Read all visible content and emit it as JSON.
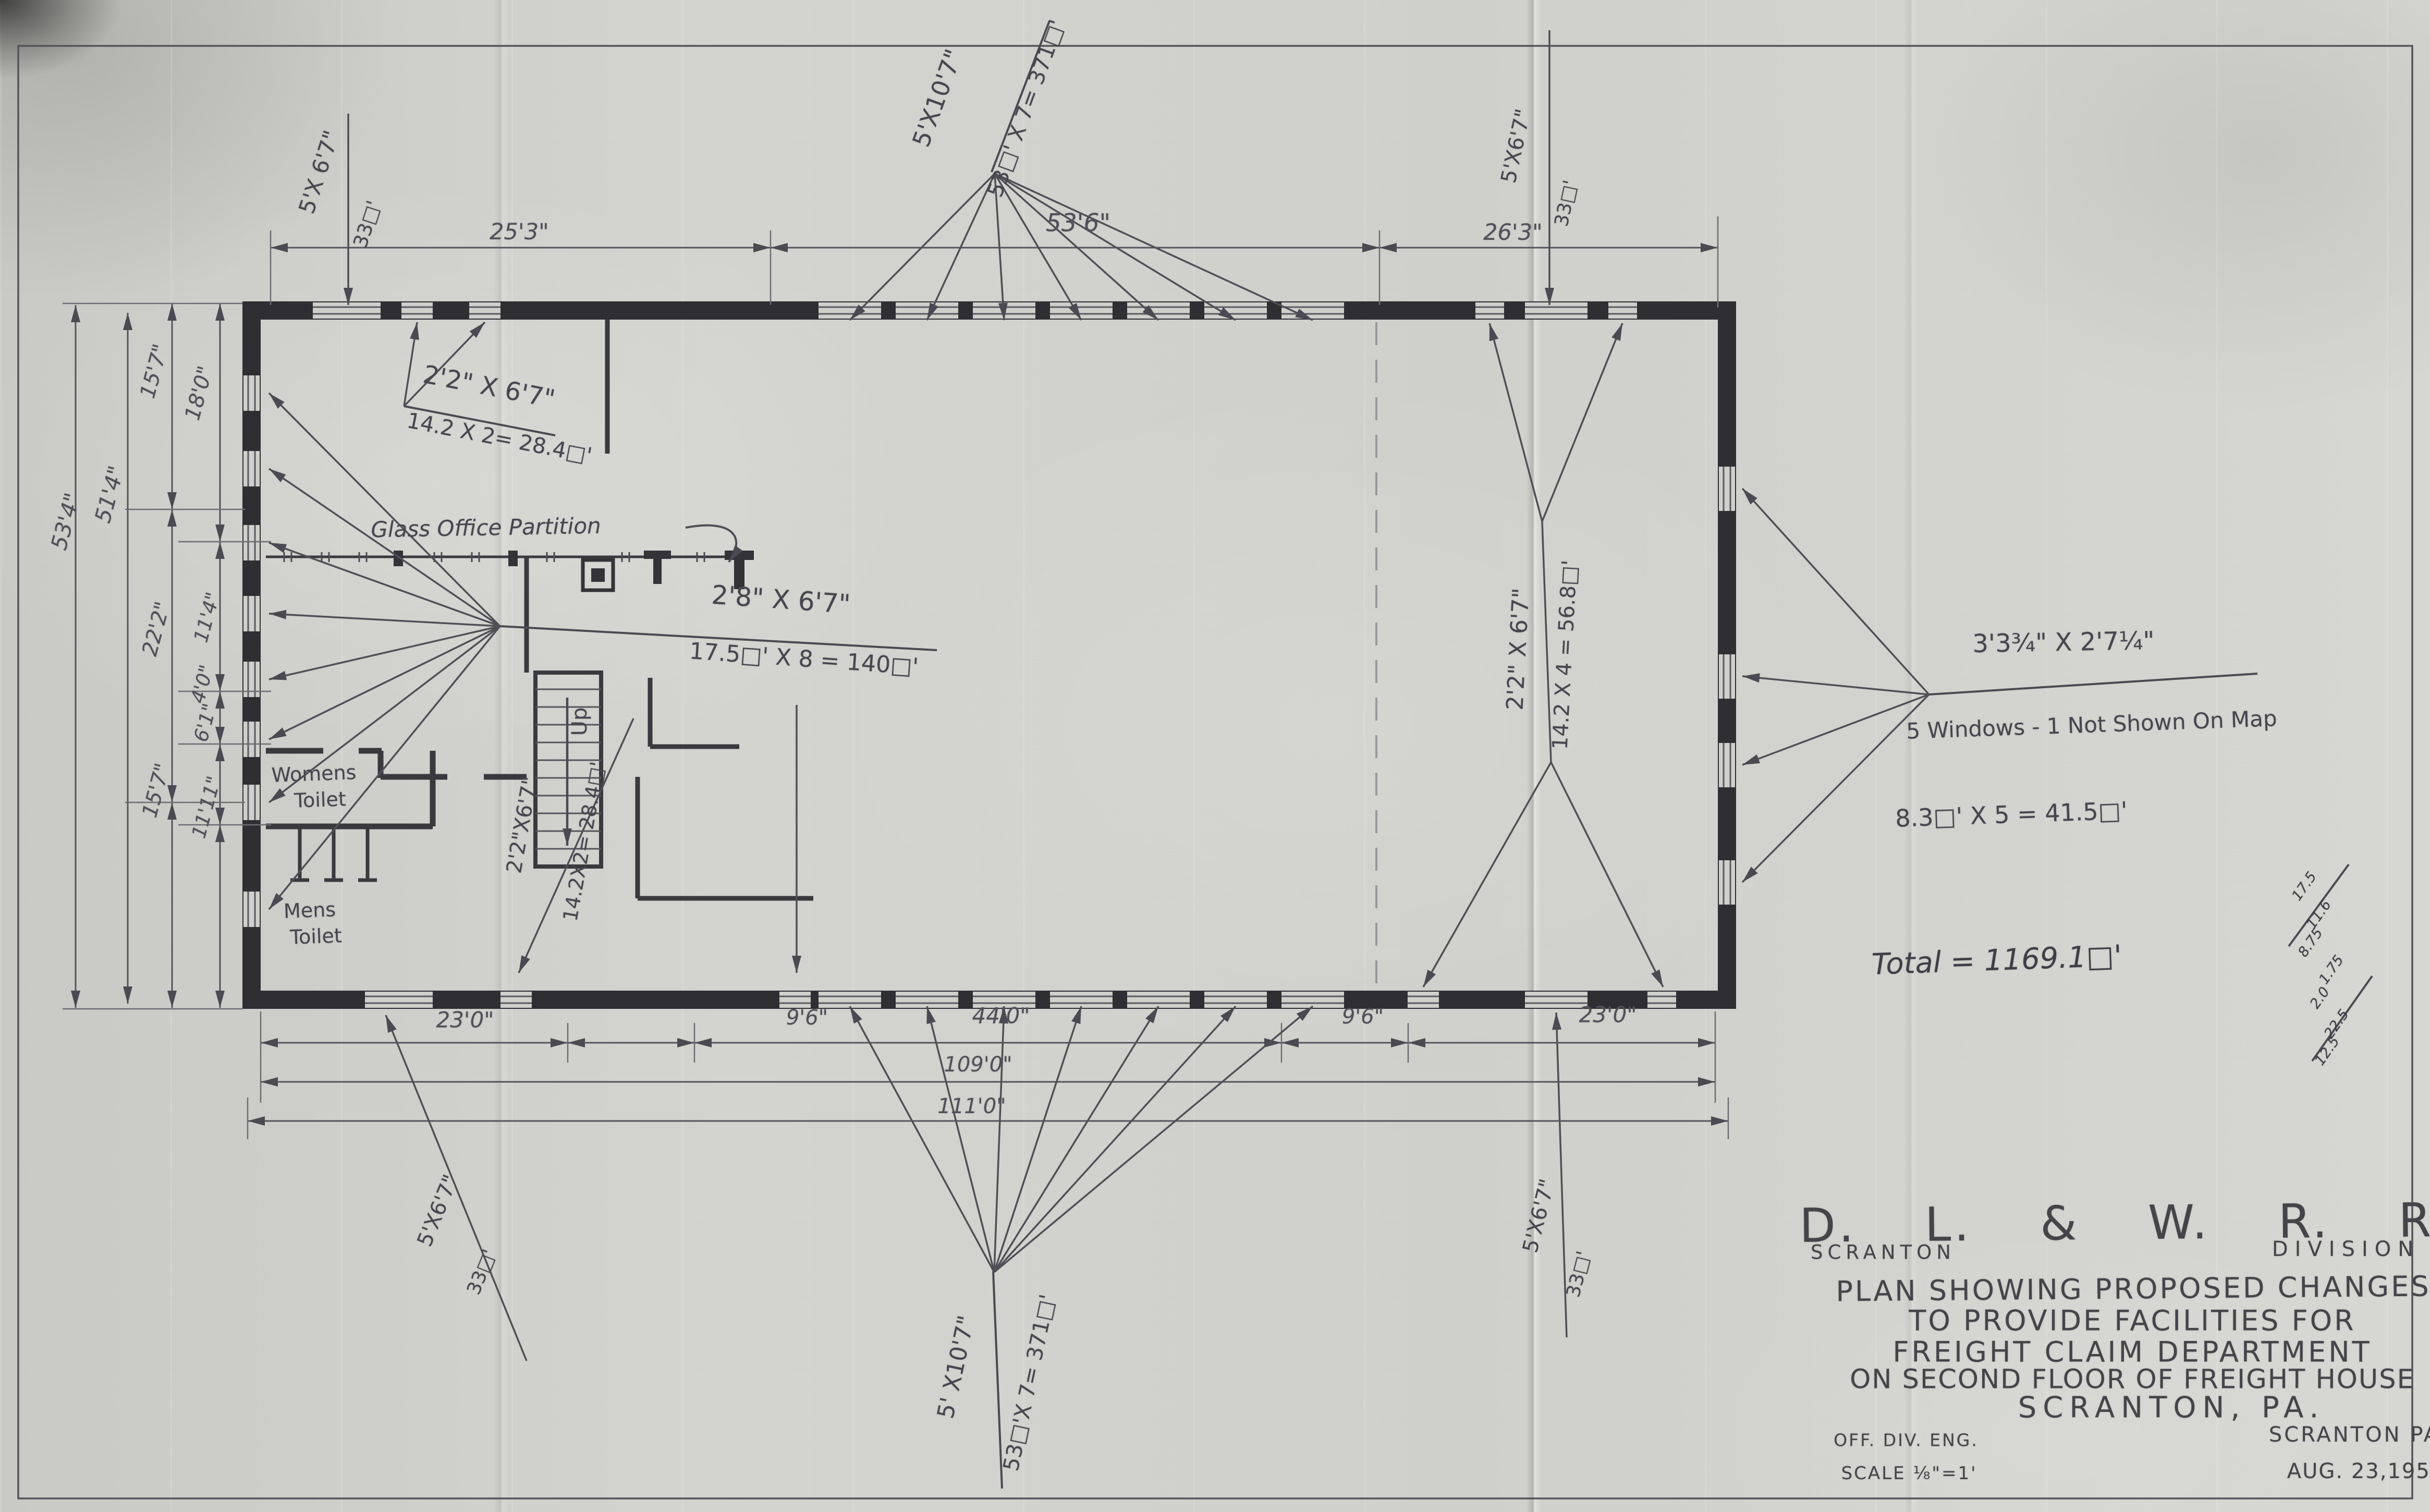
{
  "colors": {
    "paper": "#cfcfcb",
    "pencil": "#4b4a52",
    "wall": "#2f2e33"
  },
  "title_block": {
    "railroad": "D. L. & W. R. R.",
    "division_left": "SCRANTON",
    "division_right": "DIVISION",
    "lines": [
      "PLAN SHOWING PROPOSED CHANGES",
      "TO PROVIDE FACILITIES FOR",
      "FREIGHT CLAIM DEPARTMENT",
      "ON SECOND FLOOR OF FREIGHT HOUSE",
      "SCRANTON, PA."
    ],
    "office": "OFF. DIV. ENG.",
    "location": "SCRANTON PA",
    "scale": "SCALE ⅛\"=1'",
    "date": "AUG. 23,1957"
  },
  "dimensions": {
    "top": [
      "25'3\"",
      "53'6\"",
      "26'3\""
    ],
    "left": {
      "overall": "53'4\"",
      "inner": "51'4\"",
      "chain_a": [
        "15'7\"",
        "22'2\"",
        "15'7\""
      ],
      "chain_b": [
        "18'0\"",
        "11'4\"",
        "4'0\"",
        "6'1\"",
        "11'11\""
      ]
    },
    "bottom": {
      "segments": [
        "23'0\"",
        "9'6\"",
        "44'0\"",
        "9'6\"",
        "23'0\""
      ],
      "subtotal": "109'0\"",
      "total": "111'0\""
    }
  },
  "windows": {
    "top_left_single": {
      "size": "5'X 6'7\"",
      "area": "33□'"
    },
    "top_center": {
      "size": "5'X10'7\"",
      "calc": "53□' X 7= 371□'"
    },
    "top_right_single": {
      "size": "5'X6'7\"",
      "area": "33□'"
    },
    "upper_left_pair": {
      "size": "2'2\" X 6'7\"",
      "calc": "14.2 X 2= 28.4□'"
    },
    "left_wall": {
      "size": "2'8\" X 6'7\"",
      "calc": "17.5□' X 8 = 140□'"
    },
    "lower_left_pair": {
      "size": "2'2\"X6'7\"",
      "calc": "14.2X2= 28.4□'"
    },
    "bottom_left_single": {
      "size": "5'X6'7\"",
      "area": "33□'"
    },
    "bottom_center": {
      "size": "5' X10'7\"",
      "calc": "53□'X 7= 371□'"
    },
    "bottom_right_single": {
      "size": "5'X6'7\"",
      "area": "33□'"
    },
    "right_group": {
      "size": "2'2\" X 6'7\"",
      "calc": "14.2 X 4 = 56.8□'"
    },
    "right_wall": {
      "size": "3'3¾\" X 2'7¼\"",
      "note": "5 Windows - 1 Not Shown On Map",
      "calc": "8.3□' X 5 = 41.5□'"
    }
  },
  "rooms": {
    "glass_partition": "Glass Office Partition",
    "womens_line1": "Womens",
    "womens_line2": "Toilet",
    "mens_line1": "Mens",
    "mens_line2": "Toilet",
    "stair": "Up"
  },
  "summary": {
    "total": "Total = 1169.1□'",
    "scratch": [
      "17.5",
      "11.6",
      "8.75",
      "1.75",
      "2.0",
      "22.5",
      "12.5"
    ]
  }
}
